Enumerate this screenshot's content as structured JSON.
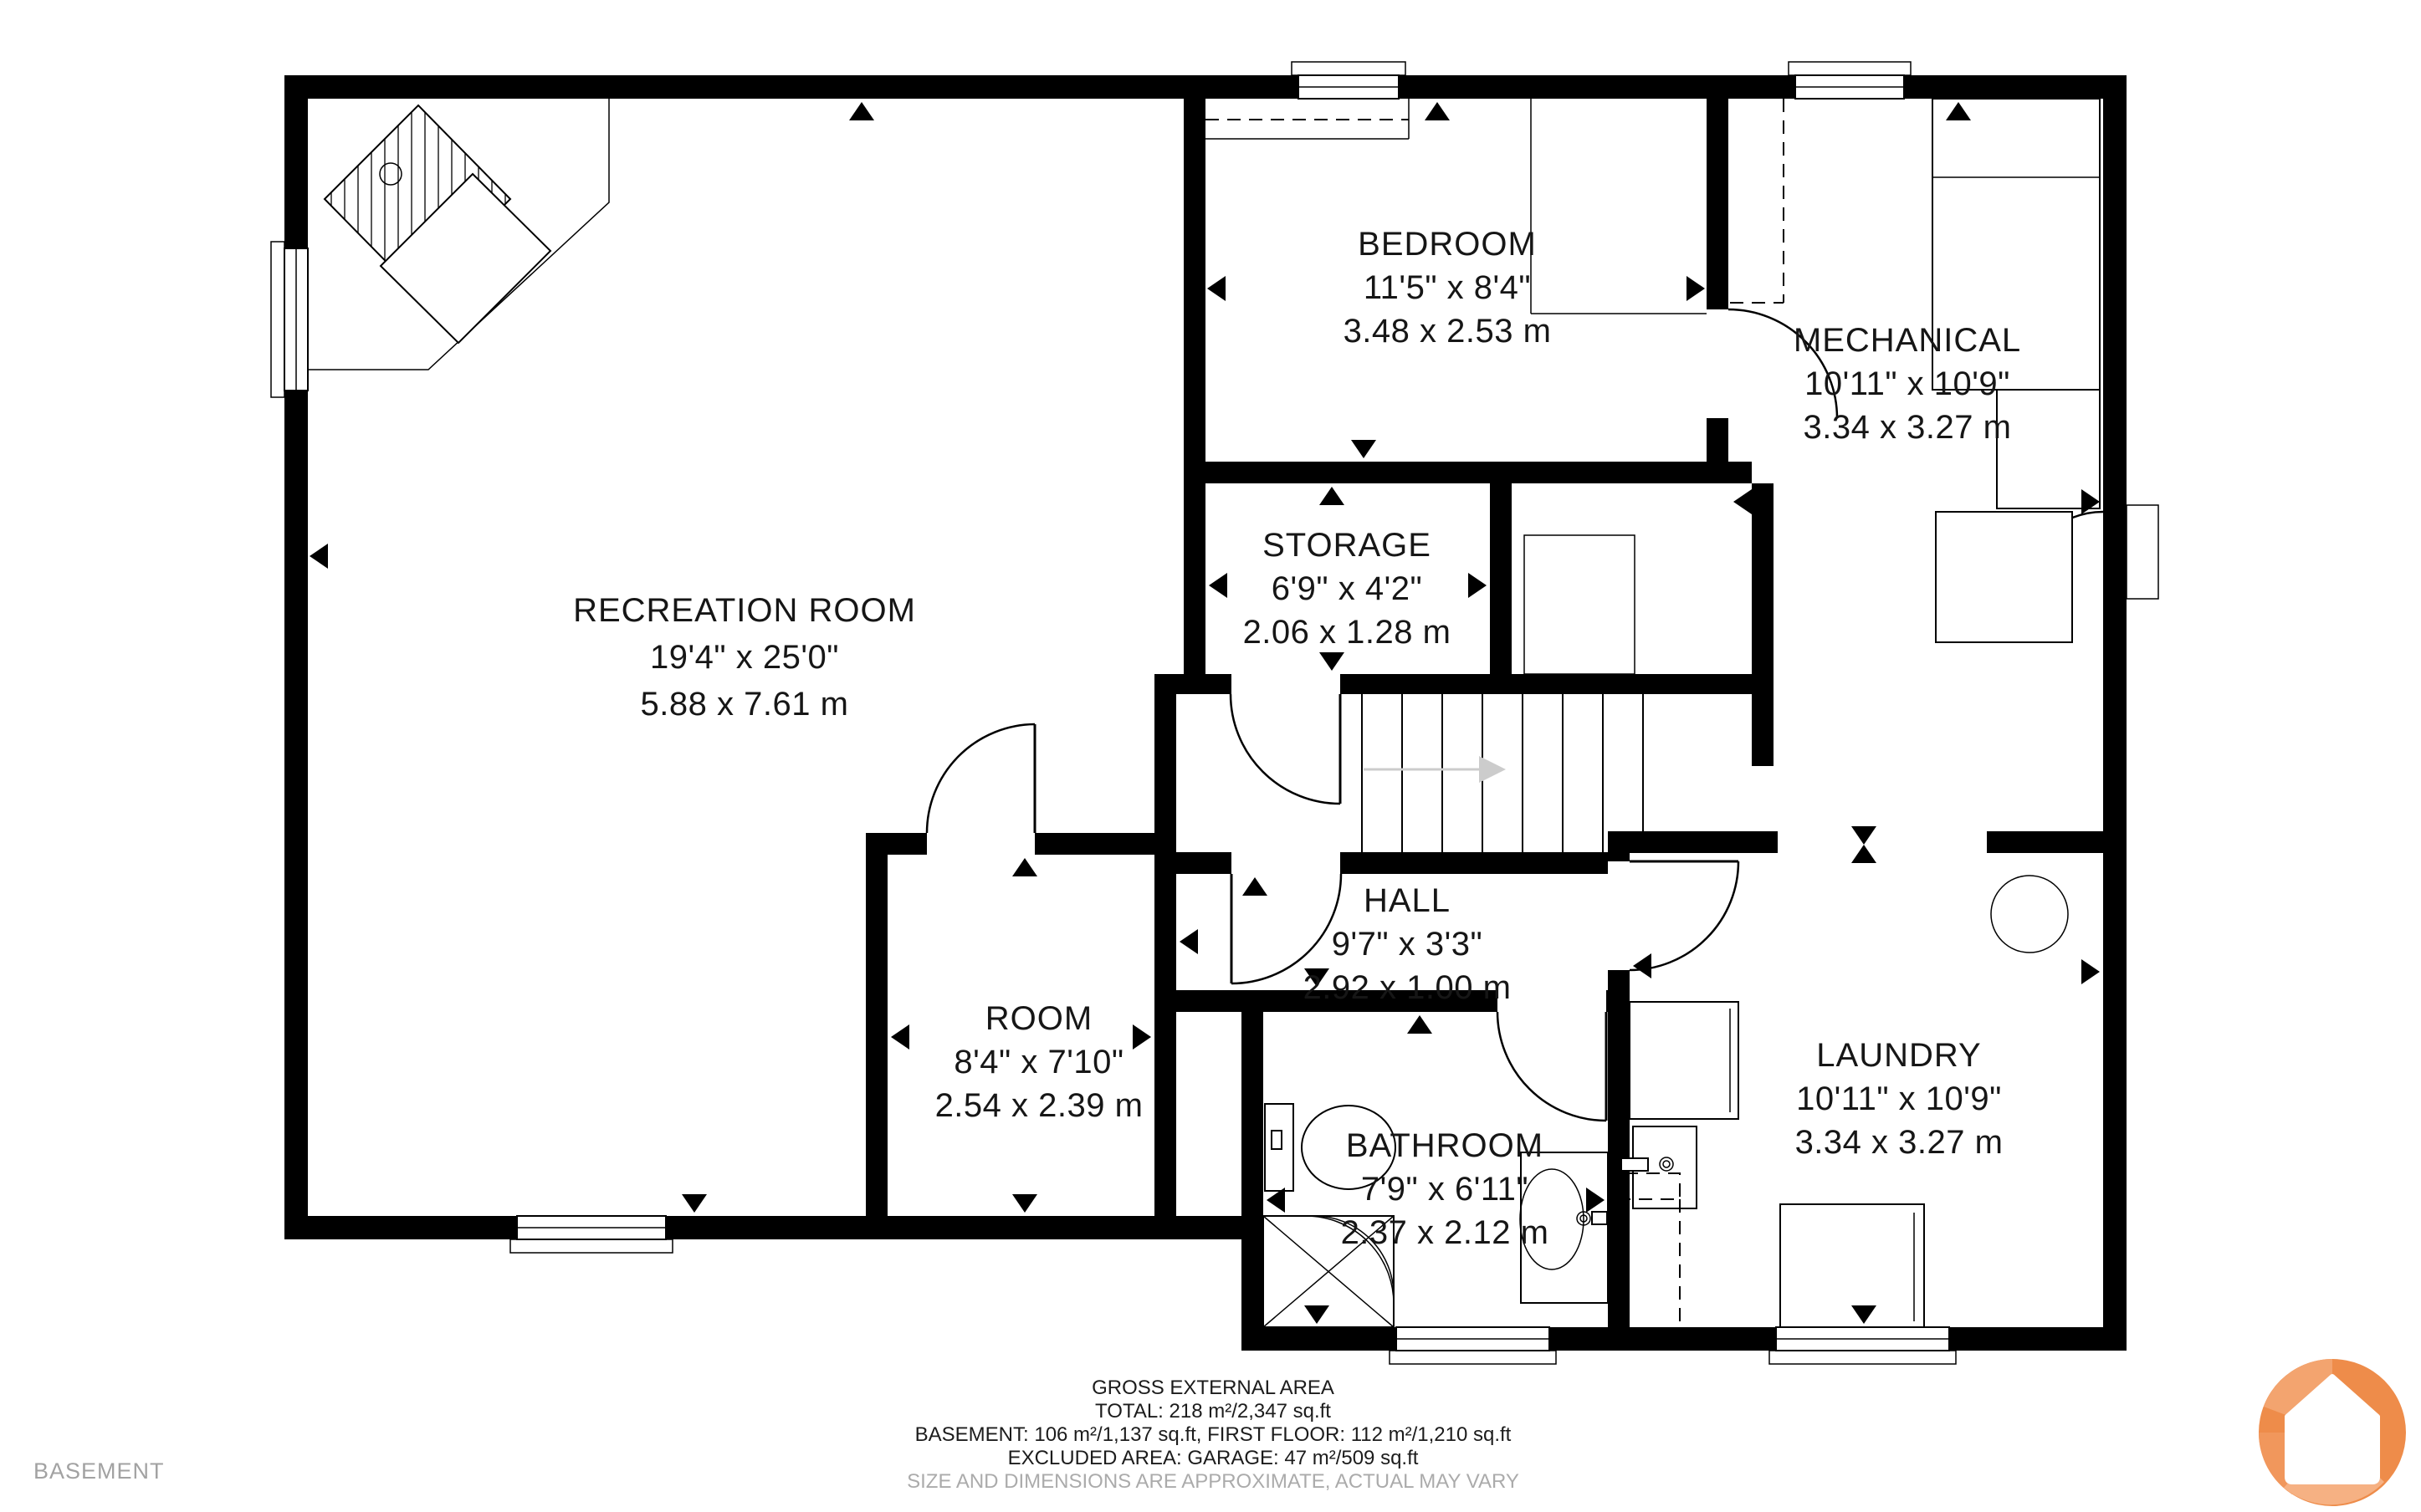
{
  "floor_label": "BASEMENT",
  "rooms": [
    {
      "name": "RECREATION ROOM",
      "imperial": "19'4\" x 25'0\"",
      "metric": "5.88 x 7.61 m"
    },
    {
      "name": "BEDROOM",
      "imperial": "11'5\" x 8'4\"",
      "metric": "3.48 x 2.53 m"
    },
    {
      "name": "MECHANICAL",
      "imperial": "10'11\" x 10'9\"",
      "metric": "3.34 x 3.27 m"
    },
    {
      "name": "STORAGE",
      "imperial": "6'9\" x 4'2\"",
      "metric": "2.06 x 1.28 m"
    },
    {
      "name": "HALL",
      "imperial": "9'7\" x 3'3\"",
      "metric": "2.92 x 1.00 m"
    },
    {
      "name": "ROOM",
      "imperial": "8'4\" x 7'10\"",
      "metric": "2.54 x 2.39 m"
    },
    {
      "name": "BATHROOM",
      "imperial": "7'9\" x 6'11\"",
      "metric": "2.37 x 2.12 m"
    },
    {
      "name": "LAUNDRY",
      "imperial": "10'11\" x 10'9\"",
      "metric": "3.34 x 3.27 m"
    }
  ],
  "footer": {
    "title": "GROSS EXTERNAL AREA",
    "total": "TOTAL: 218 m²/2,347 sq.ft",
    "floors": "BASEMENT: 106 m²/1,137 sq.ft, FIRST FLOOR: 112 m²/1,210 sq.ft",
    "excluded": "EXCLUDED AREA: GARAGE: 47 m²/509 sq.ft",
    "disclaimer": "SIZE AND DIMENSIONS ARE APPROXIMATE, ACTUAL MAY VARY"
  },
  "colors": {
    "wall": "#000000",
    "gray_text": "#a2a2a2",
    "stairs_arrow": "#cccccc",
    "logo_orange": "#ee8c4a",
    "logo_orange_light": "#f3a46f"
  }
}
